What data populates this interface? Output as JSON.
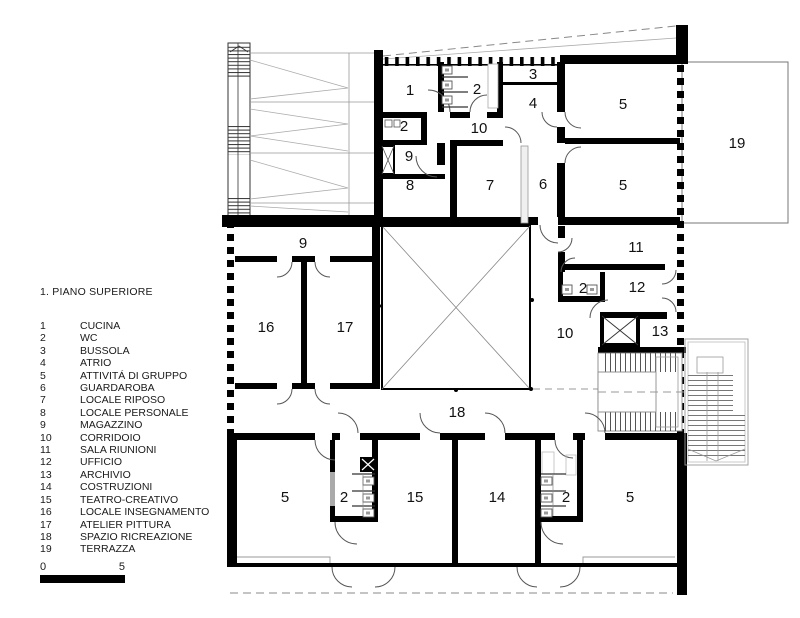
{
  "legend": {
    "title": "1. PIANO SUPERIORE",
    "items": [
      {
        "num": "1",
        "name": "CUCINA"
      },
      {
        "num": "2",
        "name": "WC"
      },
      {
        "num": "3",
        "name": "BUSSOLA"
      },
      {
        "num": "4",
        "name": "ATRIO"
      },
      {
        "num": "5",
        "name": "ATTIVITÁ DI GRUPPO"
      },
      {
        "num": "6",
        "name": "GUARDAROBA"
      },
      {
        "num": "7",
        "name": "LOCALE RIPOSO"
      },
      {
        "num": "8",
        "name": "LOCALE PERSONALE"
      },
      {
        "num": "9",
        "name": "MAGAZZINO"
      },
      {
        "num": "10",
        "name": "CORRIDOIO"
      },
      {
        "num": "11",
        "name": "SALA RIUNIONI"
      },
      {
        "num": "12",
        "name": "UFFICIO"
      },
      {
        "num": "13",
        "name": "ARCHIVIO"
      },
      {
        "num": "14",
        "name": "COSTRUZIONI"
      },
      {
        "num": "15",
        "name": "TEATRO-CREATIVO"
      },
      {
        "num": "16",
        "name": "LOCALE INSEGNAMENTO"
      },
      {
        "num": "17",
        "name": "ATELIER PITTURA"
      },
      {
        "num": "18",
        "name": "SPAZIO RICREAZIONE"
      },
      {
        "num": "19",
        "name": "TERRAZZA"
      }
    ]
  },
  "scale_bar": {
    "start": "0",
    "end": "5"
  },
  "plan": {
    "room_labels": [
      {
        "t": "1"
      },
      {
        "t": "2"
      },
      {
        "t": "3"
      },
      {
        "t": "4"
      },
      {
        "t": "10"
      },
      {
        "t": "2"
      },
      {
        "t": "9"
      },
      {
        "t": "8"
      },
      {
        "t": "7"
      },
      {
        "t": "6"
      },
      {
        "t": "5"
      },
      {
        "t": "5"
      },
      {
        "t": "19"
      },
      {
        "t": "9"
      },
      {
        "t": "16"
      },
      {
        "t": "17"
      },
      {
        "t": "11"
      },
      {
        "t": "2"
      },
      {
        "t": "12"
      },
      {
        "t": "10"
      },
      {
        "t": "13"
      },
      {
        "t": "18"
      },
      {
        "t": "5"
      },
      {
        "t": "2"
      },
      {
        "t": "15"
      },
      {
        "t": "14"
      },
      {
        "t": "2"
      },
      {
        "t": "5"
      }
    ]
  },
  "colors": {
    "wall": "#000000",
    "thin_line": "#888888",
    "hatch": "#999999",
    "text": "#111111"
  }
}
